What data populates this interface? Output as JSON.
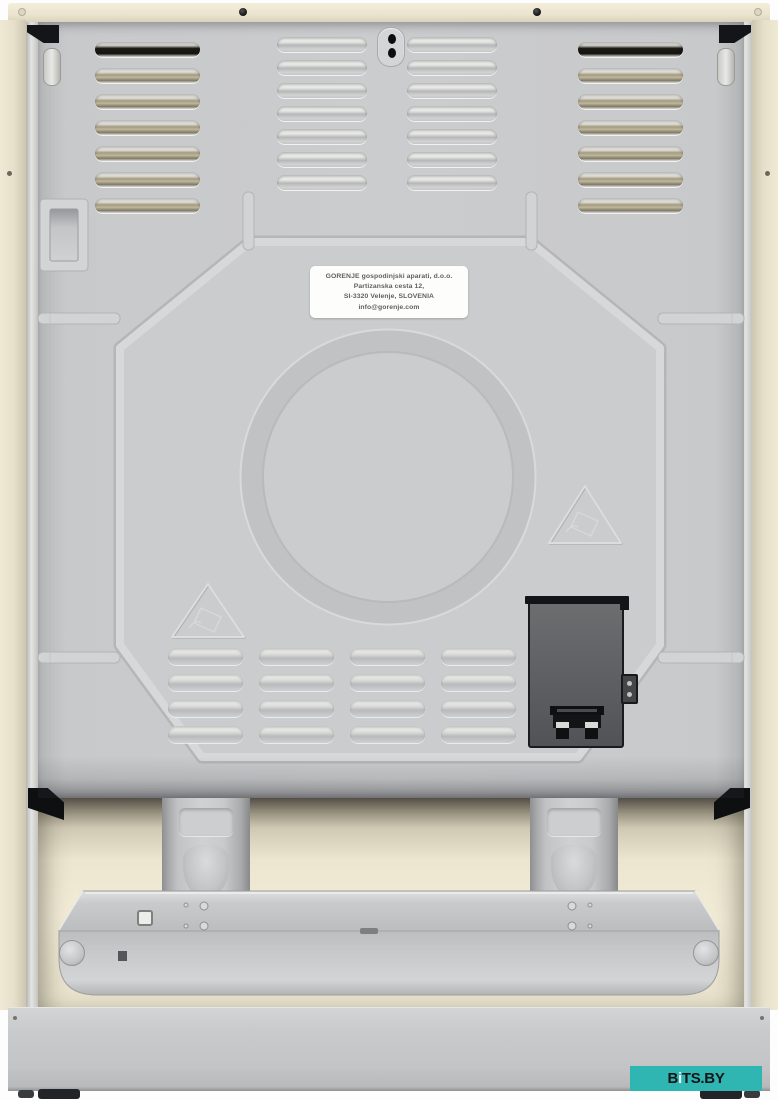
{
  "product_label": {
    "line1": "GORENJE gospodinjski aparati, d.o.o.",
    "line2": "Partizanska cesta 12,",
    "line3": "SI-3320 Velenje, SLOVENIA",
    "line4": "info@gorenje.com"
  },
  "watermark": {
    "prefix": "B",
    "letter_i": "i",
    "suffix": "TS.BY",
    "bg_color": "#2fb6b3",
    "text_color": "#151515",
    "i_color": "#e9fcfb"
  },
  "colors": {
    "worktop_cream": "#ebe4cf",
    "side_panel_cream": "#e6dfca",
    "rear_panel_gray": "#c9cacc",
    "embossed_plate_gray": "#cbccce",
    "vent_opening_dark": "#16140f",
    "vent_reflection_tan": "#a39a7e",
    "junction_box_gray": "#5c5e60",
    "junction_box_black": "#1a1b1d",
    "tray_gray": "#c5c6c8",
    "plinth_gray": "#c6c7c9",
    "background_white": "#fdfdfd"
  },
  "icons": {
    "esd_warning": "embossed-triangle-hand-symbol",
    "screws": "round-screw-heads"
  }
}
